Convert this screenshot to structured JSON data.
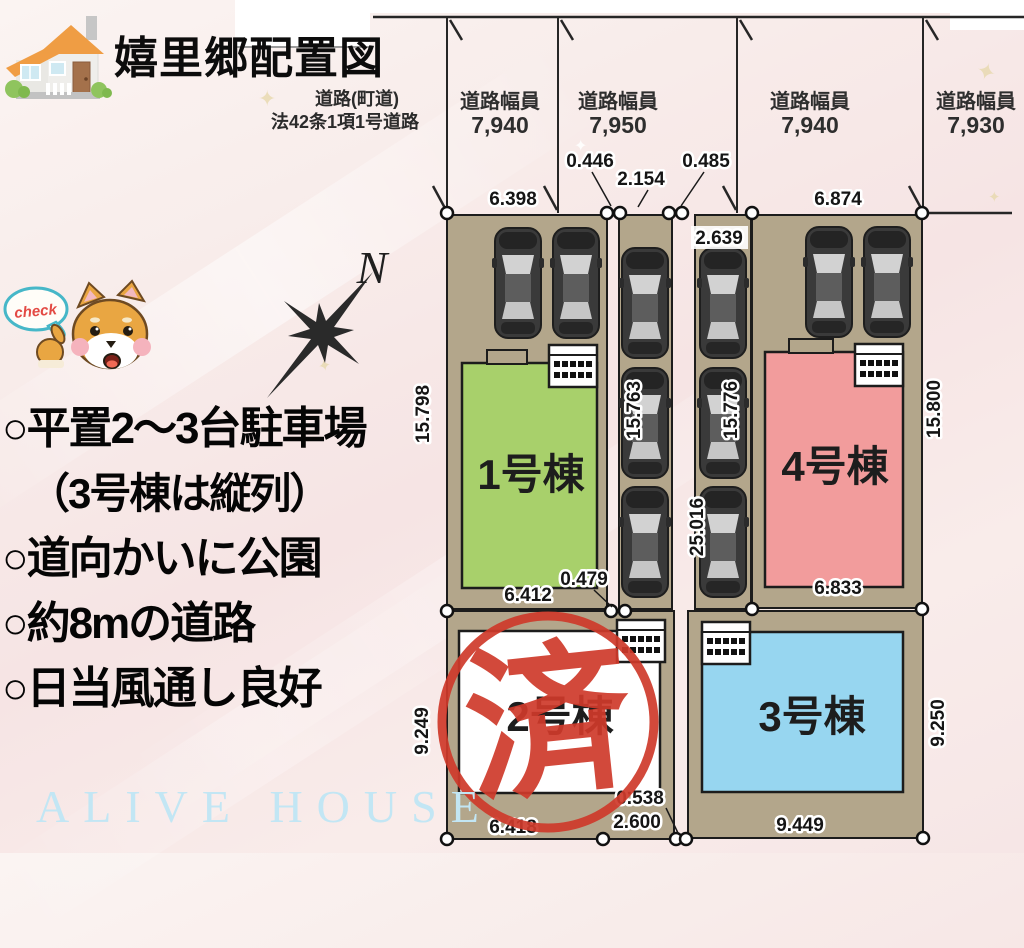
{
  "page": {
    "title": "嬉里郷配置図",
    "watermark": "ALIVE HOUSE"
  },
  "road": {
    "name_line1": "道路(町道)",
    "name_line2": "法42条1項1号道路",
    "sections": [
      {
        "label": "道路幅員",
        "value": "7,940"
      },
      {
        "label": "道路幅員",
        "value": "7,950"
      },
      {
        "label": "道路幅員",
        "value": "7,940"
      },
      {
        "label": "道路幅員",
        "value": "7,930"
      }
    ]
  },
  "dims": {
    "top_lot1": "6.398",
    "top_gap1": "0.446",
    "top_strip2": "2.154",
    "top_gap2": "0.485",
    "top_lot4": "6.874",
    "top_strip3": "2.639",
    "left_lot1": "15.798",
    "strip2_len": "15.763",
    "strip3_len": "15.776",
    "strip3_total": "25.016",
    "right_lot4": "15.800",
    "bottom_lot1": "6.412",
    "bottom_gap1": "0.479",
    "bottom_lot4": "6.833",
    "left_lot2": "9.249",
    "right_lot3": "9.250",
    "bottom_lot2": "6.418",
    "bottom_gap2": "0.538",
    "bottom_strip3": "2.600",
    "bottom_lot3": "9.449"
  },
  "buildings": [
    {
      "label": "1号棟",
      "color": "#a8d06b"
    },
    {
      "label": "2号棟",
      "color": "#ffffff"
    },
    {
      "label": "3号棟",
      "color": "#97d6f0"
    },
    {
      "label": "4号棟",
      "color": "#f29c9c"
    }
  ],
  "stamp": {
    "label": "済",
    "color": "#cf3a2b"
  },
  "compass": {
    "label": "N"
  },
  "mascot": {
    "bubble_label": "check"
  },
  "notes": [
    "○平置2〜3台駐車場",
    "（3号棟は縦列）",
    "○道向かいに公園",
    "○約8mの道路",
    "○日当風通し良好"
  ],
  "colors": {
    "parcel_tan": "#b3a68b",
    "accent_teal": "#46b7c8",
    "stamp_red": "#cf3a2b",
    "watermark_blue": "#c2e6f4"
  }
}
